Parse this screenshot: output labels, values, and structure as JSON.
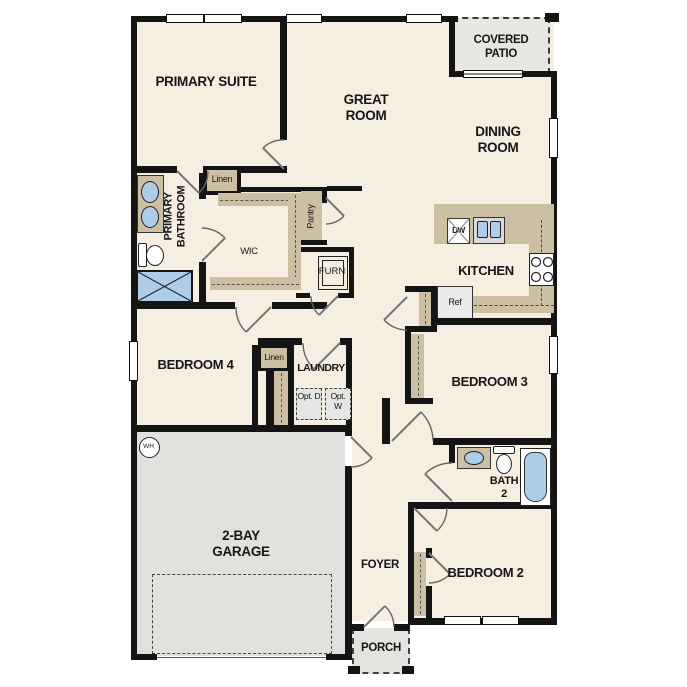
{
  "meta": {
    "type": "single-story floor plan"
  },
  "colors": {
    "floor_beige": "#f6eee1",
    "wall_black": "#141414",
    "cabinet_tan": "#cdbfa4",
    "concrete_gray": "#e2e1de",
    "fixture_blue": "#aecde9"
  },
  "rooms": {
    "primary_suite": {
      "label": "PRIMARY SUITE"
    },
    "great_room": {
      "label": "GREAT ROOM"
    },
    "covered_patio": {
      "label": "COVERED PATIO"
    },
    "dining_room": {
      "label": "DINING ROOM"
    },
    "primary_bathroom": {
      "label": "PRIMARY BATHROOM"
    },
    "wic": {
      "label": "WIC"
    },
    "linen_upper": {
      "label": "Linen"
    },
    "pantry": {
      "label": "Pantry"
    },
    "furnace": {
      "label": "FURN"
    },
    "kitchen": {
      "label": "KITCHEN"
    },
    "bedroom4": {
      "label": "BEDROOM 4"
    },
    "linen_hall": {
      "label": "Linen"
    },
    "laundry": {
      "label": "LAUNDRY"
    },
    "bedroom3": {
      "label": "BEDROOM 3"
    },
    "bath2": {
      "label": "BATH 2"
    },
    "garage": {
      "label": "2-BAY GARAGE"
    },
    "foyer": {
      "label": "FOYER"
    },
    "bedroom2": {
      "label": "BEDROOM 2"
    },
    "porch": {
      "label": "PORCH"
    }
  },
  "appliances": {
    "dishwasher": {
      "label": "DW"
    },
    "refrigerator": {
      "label": "Ref"
    },
    "water_heater": {
      "label": "WH"
    },
    "opt_dryer": {
      "label": "Opt. D"
    },
    "opt_washer": {
      "label": "Opt. W"
    }
  }
}
